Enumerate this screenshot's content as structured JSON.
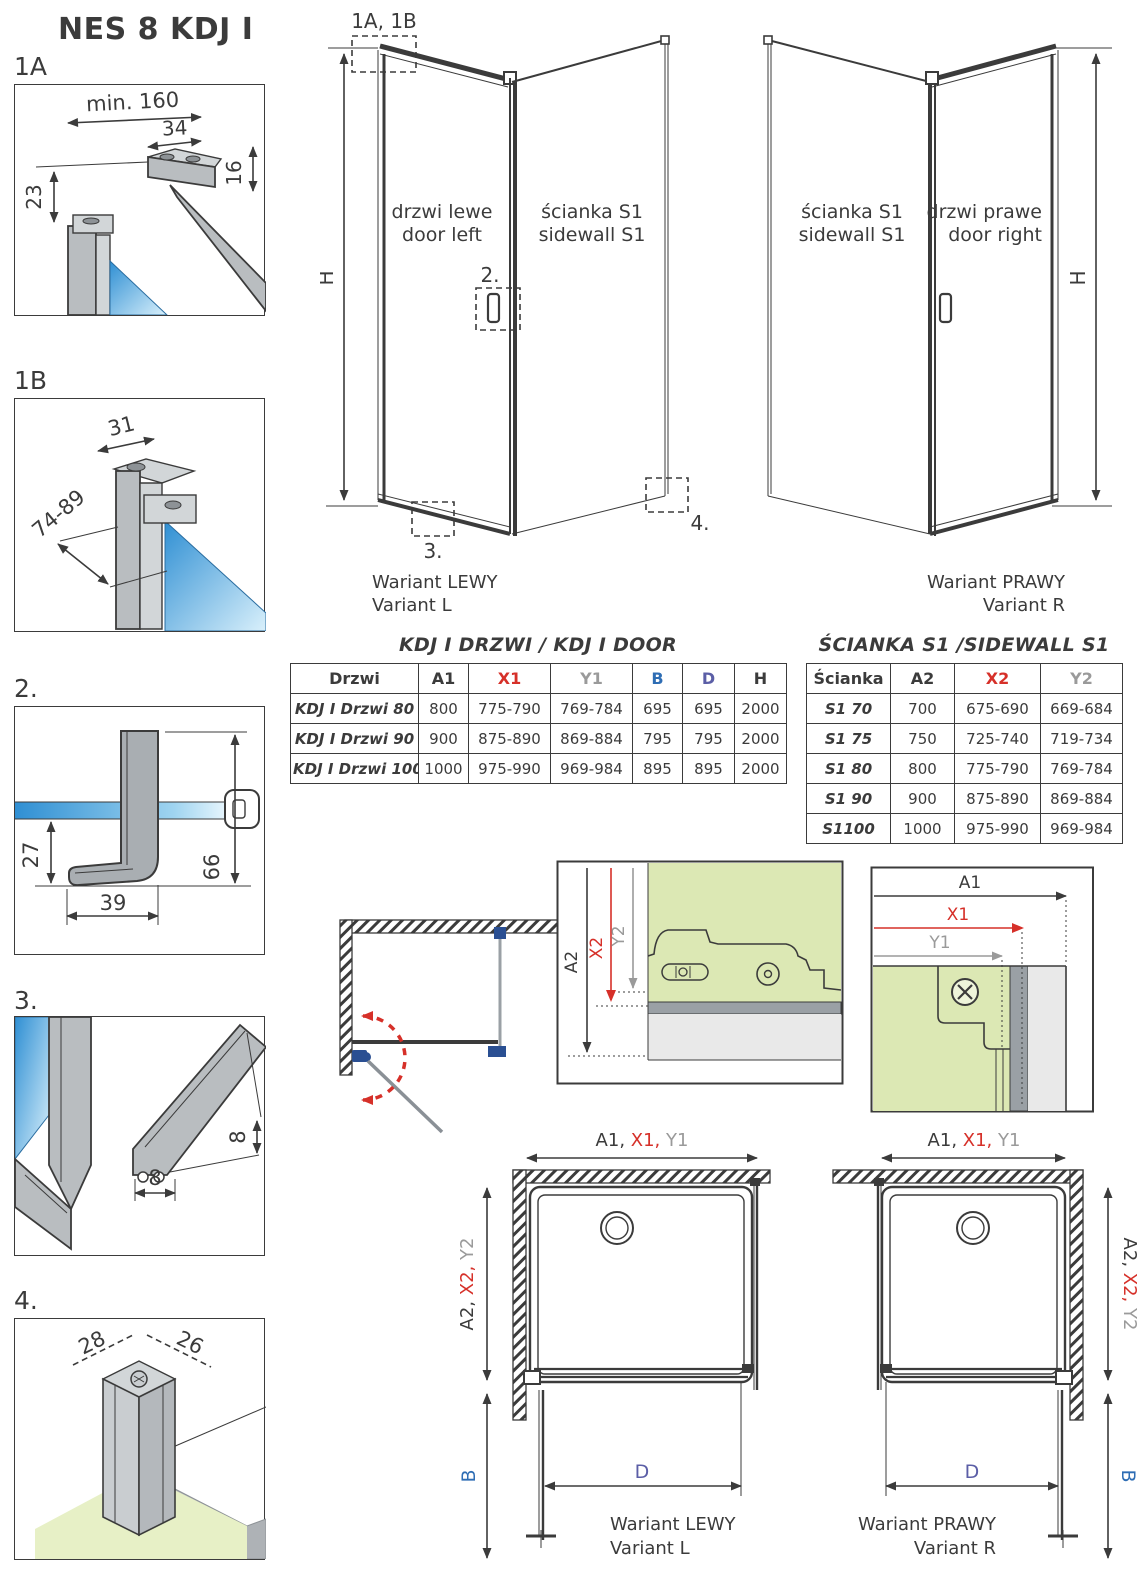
{
  "colors": {
    "ink": "#3b3b3b",
    "red": "#d63029",
    "gray": "#9a9a9a",
    "blue": "#2e6db4",
    "indigo": "#5b5ea6",
    "green": "#dce8b4",
    "glass_blue": "#2f8fd3",
    "profile_gray": "#b9bdc0",
    "clamp_blue": "#2a4f92"
  },
  "header": {
    "title": "NES 8 KDJ I"
  },
  "details": {
    "d1a": {
      "label": "1A",
      "dim_min": "min. 160",
      "dim_34": "34",
      "dim_16": "16",
      "dim_23": "23"
    },
    "d1b": {
      "label": "1B",
      "dim_31": "31",
      "dim_range": "74-89"
    },
    "d2": {
      "label": "2.",
      "dim_27": "27",
      "dim_39": "39",
      "dim_66": "66"
    },
    "d3": {
      "label": "3.",
      "dim_8v": "8",
      "dim_8h": "8"
    },
    "d4": {
      "label": "4.",
      "dim_28": "28",
      "dim_26": "26"
    }
  },
  "variant_l": {
    "ref_1ab": "1A, 1B",
    "ref_2": "2.",
    "ref_3": "3.",
    "ref_4": "4.",
    "door_pl": "drzwi lewe",
    "door_en": "door left",
    "wall_pl": "ścianka S1",
    "wall_en": "sidewall S1",
    "h": "H",
    "caption_pl": "Wariant LEWY",
    "caption_en": "Variant L"
  },
  "variant_r": {
    "door_pl": "drzwi prawe",
    "door_en": "door right",
    "wall_pl": "ścianka S1",
    "wall_en": "sidewall S1",
    "h": "H",
    "caption_pl": "Wariant PRAWY",
    "caption_en": "Variant R"
  },
  "door_table": {
    "title": "KDJ I DRZWI / KDJ I DOOR",
    "headers": [
      {
        "label": "Drzwi",
        "color": "ink"
      },
      {
        "label": "A1",
        "color": "ink"
      },
      {
        "label": "X1",
        "color": "red"
      },
      {
        "label": "Y1",
        "color": "gray"
      },
      {
        "label": "B",
        "color": "blue"
      },
      {
        "label": "D",
        "color": "indigo"
      },
      {
        "label": "H",
        "color": "ink"
      }
    ],
    "rows": [
      [
        "KDJ I Drzwi 80",
        "800",
        "775-790",
        "769-784",
        "695",
        "695",
        "2000"
      ],
      [
        "KDJ I Drzwi 90",
        "900",
        "875-890",
        "869-884",
        "795",
        "795",
        "2000"
      ],
      [
        "KDJ I Drzwi 100",
        "1000",
        "975-990",
        "969-984",
        "895",
        "895",
        "2000"
      ]
    ]
  },
  "sidewall_table": {
    "title": "ŚCIANKA S1 /SIDEWALL S1",
    "headers": [
      {
        "label": "Ścianka",
        "color": "ink"
      },
      {
        "label": "A2",
        "color": "ink"
      },
      {
        "label": "X2",
        "color": "red"
      },
      {
        "label": "Y2",
        "color": "gray"
      }
    ],
    "rows": [
      [
        "S1 70",
        "700",
        "675-690",
        "669-684"
      ],
      [
        "S1 75",
        "750",
        "725-740",
        "719-734"
      ],
      [
        "S1 80",
        "800",
        "775-790",
        "769-784"
      ],
      [
        "S1 90",
        "900",
        "875-890",
        "869-884"
      ],
      [
        "S1100",
        "1000",
        "975-990",
        "969-984"
      ]
    ]
  },
  "mid_left": {
    "a2": "A2",
    "x2": "X2",
    "y2": "Y2"
  },
  "mid_right": {
    "a1": "A1",
    "x1": "X1",
    "y1": "Y1"
  },
  "plan_l": {
    "top_a1": "A1, ",
    "top_x1": "X1, ",
    "top_y1": "Y1",
    "side_a2": "A2, ",
    "side_x2": "X2, ",
    "side_y2": "Y2",
    "b": "B",
    "d": "D",
    "caption_pl": "Wariant LEWY",
    "caption_en": "Variant L"
  },
  "plan_r": {
    "top_a1": "A1, ",
    "top_x1": "X1, ",
    "top_y1": "Y1",
    "side_a2": "A2, ",
    "side_x2": "X2, ",
    "side_y2": "Y2",
    "b": "B",
    "d": "D",
    "caption_pl": "Wariant PRAWY",
    "caption_en": "Variant R"
  }
}
